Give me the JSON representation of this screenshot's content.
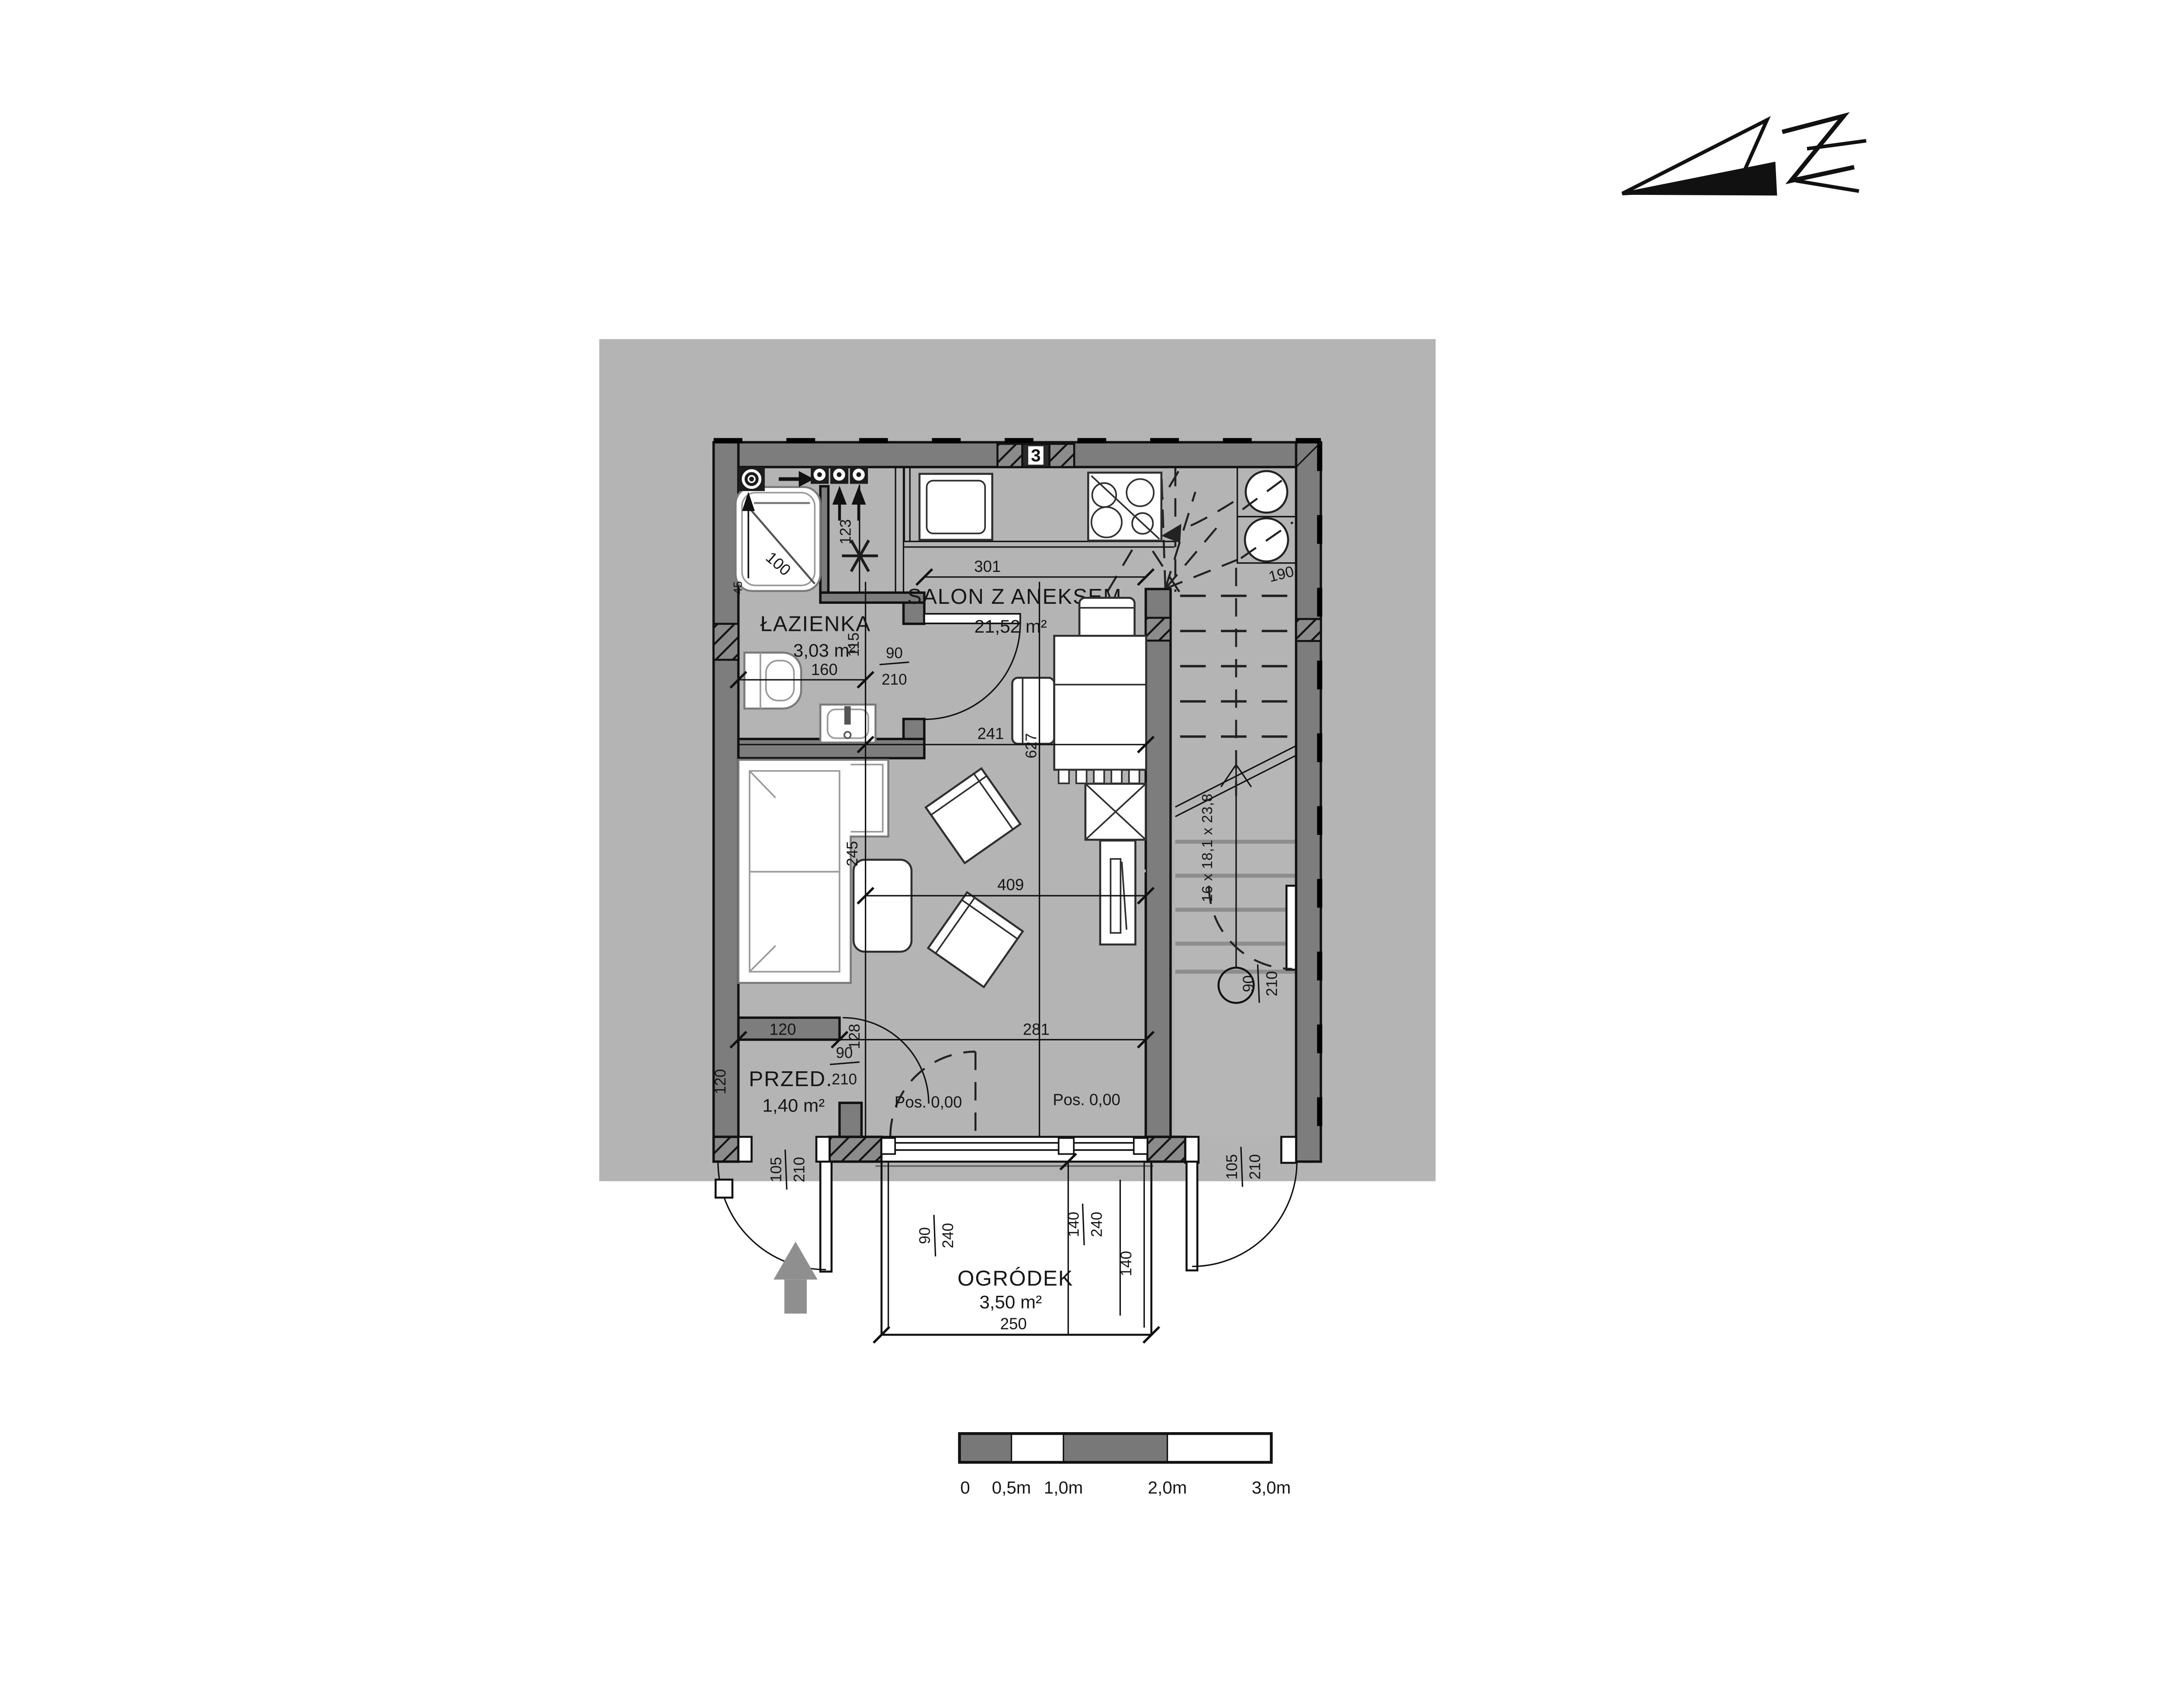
{
  "rooms": {
    "bathroom": {
      "label": "ŁAZIENKA",
      "area": "3,03 m²"
    },
    "living": {
      "label": "SALON Z ANEKSEM",
      "area": "21,52 m²"
    },
    "hall": {
      "label": "PRZED.",
      "area": "1,40 m²"
    },
    "garden": {
      "label": "OGRÓDEK",
      "area": "3,50 m²"
    }
  },
  "levels": {
    "living": "Pos. 0,00",
    "entry": "Pos. 0,00"
  },
  "dims": {
    "shower_diag": "100",
    "shower_side": "45",
    "fridge_niche": "123",
    "bath_width": "160",
    "bath_jamb": "115",
    "door90_w": "90",
    "door90_h": "210",
    "kitchen_run": "301",
    "table_run": "241",
    "salon_depth": "627",
    "salon_run": "409",
    "sofa_depth": "245",
    "hall_top": "120",
    "hall_left": "120",
    "hall_jamb": "128",
    "salon_bottom": "281",
    "entry_w": "105",
    "entry_h": "210",
    "exit_w": "105",
    "exit_h": "210",
    "win_left_w": "90",
    "win_left_h": "240",
    "win_right_w": "140",
    "win_right_h": "240",
    "terrace_depth": "140",
    "terrace_width": "250"
  },
  "stairs": {
    "run": "16 x 18,1 x 23,8",
    "width": "190"
  },
  "shaft_badge": "3",
  "scalebar": {
    "t0": "0",
    "t05": "0,5m",
    "t1": "1,0m",
    "t2": "2,0m",
    "t3": "3,0m"
  },
  "colors": {
    "site": "#b4b4b4",
    "wall": "#7d7d7d",
    "stair_floor": "#b6b6b6",
    "entry_arrow": "#8f8f8f"
  }
}
